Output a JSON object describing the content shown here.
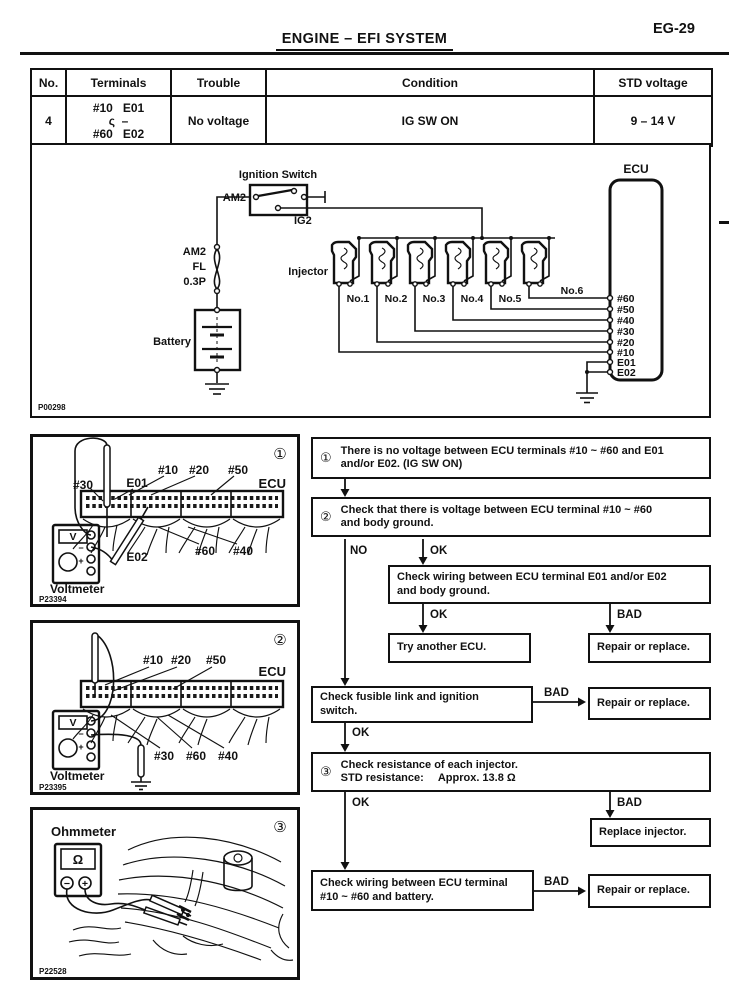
{
  "page": {
    "title": "ENGINE – EFI SYSTEM",
    "code": "EG-29"
  },
  "table": {
    "headers": [
      "No.",
      "Terminals",
      "Trouble",
      "Condition",
      "STD voltage"
    ],
    "row": {
      "no": "4",
      "terminals": [
        "#10   E01",
        "ς  –",
        "#60   E02"
      ],
      "trouble": "No voltage",
      "condition": "IG SW ON",
      "std": "9 – 14 V"
    }
  },
  "circuit": {
    "code": "P00298",
    "ignition_switch": "Ignition Switch",
    "am2": "AM2",
    "ig2": "IG2",
    "fusible": [
      "AM2",
      "FL",
      "0.3P"
    ],
    "battery": "Battery",
    "injector": "Injector",
    "injectors": [
      "No.1",
      "No.2",
      "No.3",
      "No.4",
      "No.5",
      "No.6"
    ],
    "ecu": "ECU",
    "terminals": [
      "#60",
      "#50",
      "#40",
      "#30",
      "#20",
      "#10",
      "E01",
      "E02"
    ]
  },
  "fig1": {
    "num": "①",
    "ecu": "ECU",
    "t30": "#30",
    "e01": "E01",
    "t10": "#10",
    "t20": "#20",
    "t50": "#50",
    "e02": "E02",
    "t60": "#60",
    "t40": "#40",
    "meter": "Voltmeter",
    "display": "V",
    "minus": "−",
    "plus": "+",
    "code": "P23394"
  },
  "fig2": {
    "num": "②",
    "ecu": "ECU",
    "t10": "#10",
    "t20": "#20",
    "t50": "#50",
    "t30": "#30",
    "t60": "#60",
    "t40": "#40",
    "meter": "Voltmeter",
    "display": "V",
    "minus": "−",
    "plus": "+",
    "code": "P23395"
  },
  "fig3": {
    "num": "③",
    "meter": "Ohmmeter",
    "display": "Ω",
    "minus": "−",
    "plus": "+",
    "code": "P22528"
  },
  "flow": {
    "s1": {
      "num": "①",
      "l1": "There is no voltage between ECU terminals #10 ~ #60 and E01",
      "l2": "and/or E02.",
      "l2b": "(IG SW ON)"
    },
    "s2": {
      "num": "②",
      "l1": "Check that there is voltage between ECU terminal #10 ~ #60",
      "l2": "and body ground."
    },
    "wiring_e": {
      "l1": "Check wiring between ECU terminal E01 and/or E02",
      "l2": "and body ground."
    },
    "try_ecu": "Try another ECU.",
    "repair1": "Repair or replace.",
    "fusible": {
      "l1": "Check fusible link and ignition",
      "l2": "switch."
    },
    "repair2": "Repair or replace.",
    "s3": {
      "num": "③",
      "l1": "Check resistance of each injector.",
      "l2a": "STD resistance:",
      "l2b": "Approx. 13.8 Ω"
    },
    "replace_inj": "Replace injector.",
    "wiring_b": {
      "l1": "Check wiring between ECU terminal",
      "l2": "#10 ~ #60 and battery."
    },
    "repair3": "Repair or replace.",
    "no": "NO",
    "ok": "OK",
    "bad": "BAD"
  }
}
